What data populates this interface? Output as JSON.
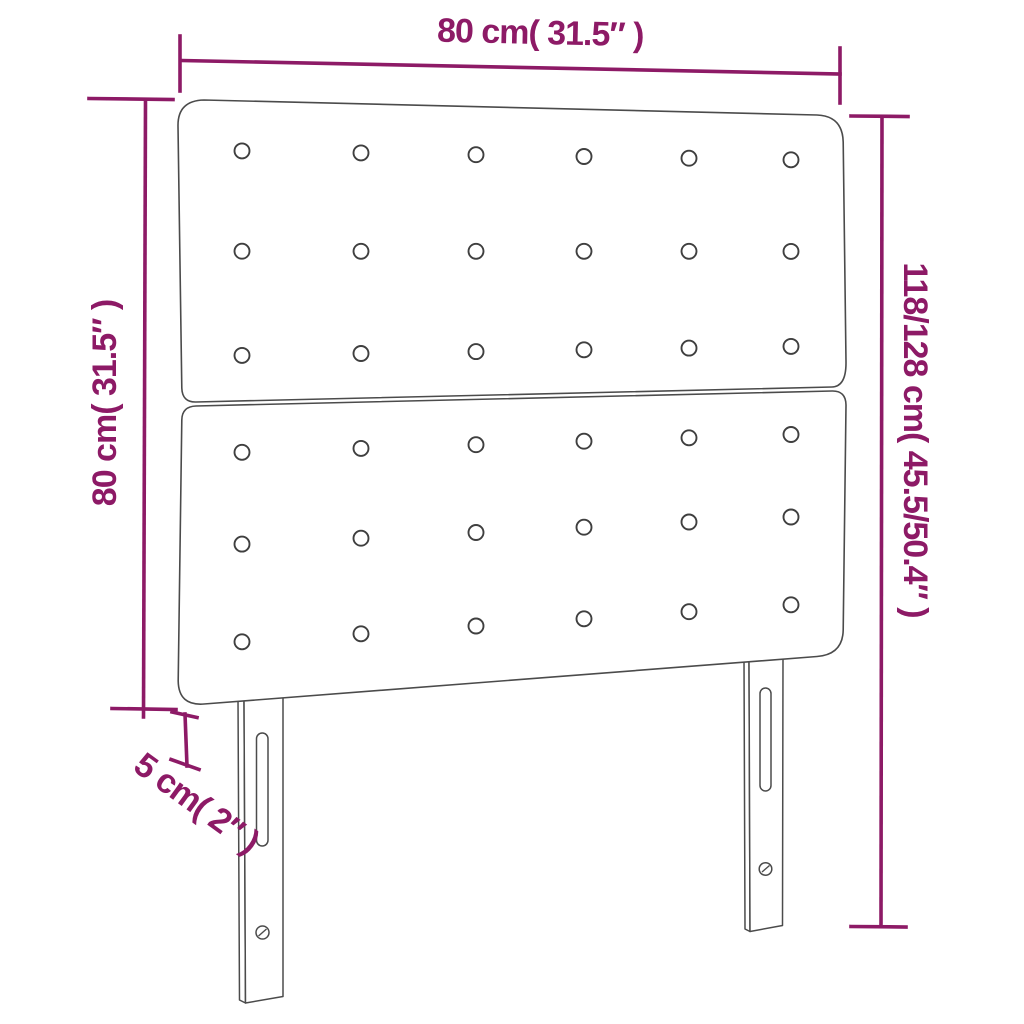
{
  "diagram": {
    "type": "product-dimension-diagram",
    "subject": "upholstered-headboard-with-two-panels-and-two-slotted-legs",
    "colors": {
      "dimension_accent": "#8D1A66",
      "outline_gray": "#4B4B4B",
      "background": "#FFFFFF"
    },
    "labels": {
      "width": "80 cm( 31.5″ )",
      "height": "80 cm( 31.5″ )",
      "total_height": "118/128 cm( 45.5/50.4″ )",
      "thickness": "5 cm( 2″ )"
    },
    "values": {
      "width_cm": "80",
      "width_in": "31.5",
      "panel_height_cm": "80",
      "panel_height_in": "31.5",
      "total_height_cm": "118/128",
      "total_height_in": "45.5/50.4",
      "thickness_cm": "5",
      "thickness_in": "2"
    },
    "buttons": {
      "columns_x": [
        242,
        361,
        476,
        584,
        689,
        791
      ],
      "top_panel_row_fractions": [
        0.165,
        0.5,
        0.848
      ],
      "bottom_panel_row_fractions": [
        0.16,
        0.47,
        0.8
      ],
      "radius": 7.5,
      "count_per_panel": 18,
      "count_total": 36
    }
  }
}
